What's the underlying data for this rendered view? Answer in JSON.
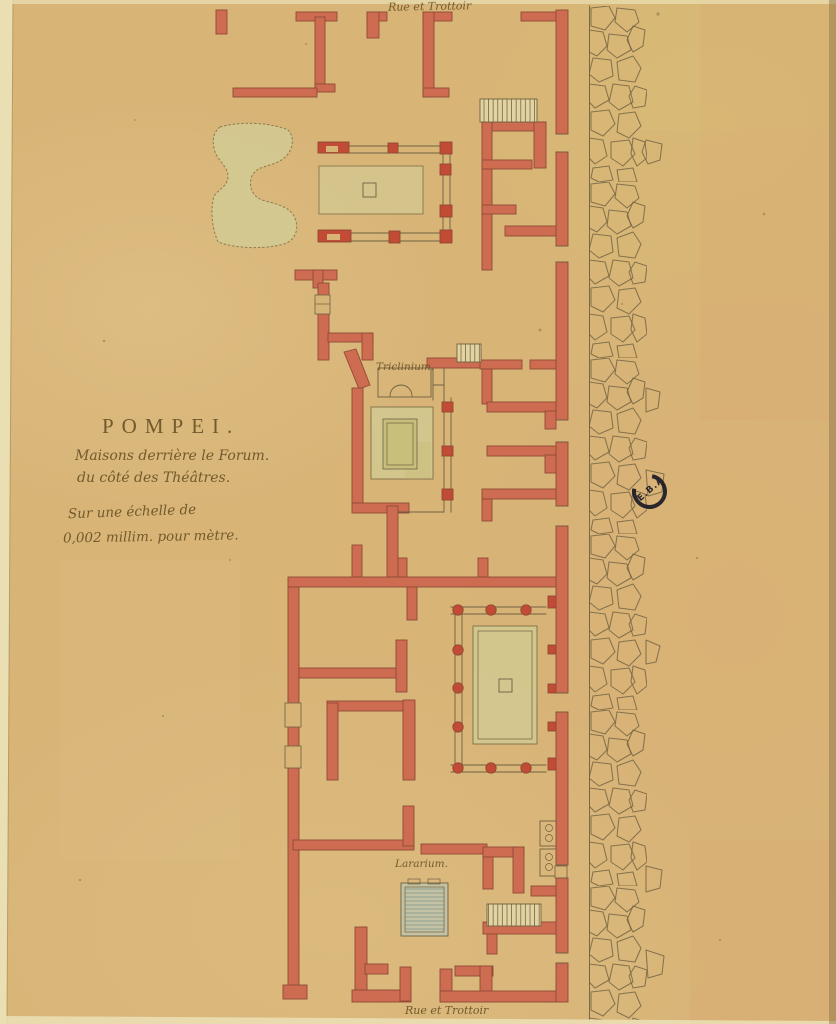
{
  "document": {
    "kind": "hand-drawn floor plan of houses at Pompeii",
    "title": "POMPEI.",
    "subtitle_1": "Maisons derrière le Forum.",
    "subtitle_2": "du côté des Théâtres.",
    "scale_1": "Sur une échelle de",
    "scale_2": "0,002 millim. pour mètre.",
    "street_labels": {
      "top": "Rue et Trottoir",
      "bottom": "Rue et Trottoir"
    },
    "room_labels": {
      "triclinium": "Triclinium.",
      "lararium": "Lararium."
    },
    "stamp_text": "E.B.A",
    "colors": {
      "paper": "#d8b477",
      "paper_edge": "#eadfb2",
      "wall_red": "#cd6c51",
      "wall_red_bright": "#c24b36",
      "wall_outline": "#8f4a34",
      "ink": "#6f6140",
      "wash_green": "#d3ca92",
      "wash_green_deep": "#c9bf7c",
      "hatch_blue": "#97a694",
      "handwriting": "#6b5426",
      "stamp": "#1b1b26"
    }
  }
}
